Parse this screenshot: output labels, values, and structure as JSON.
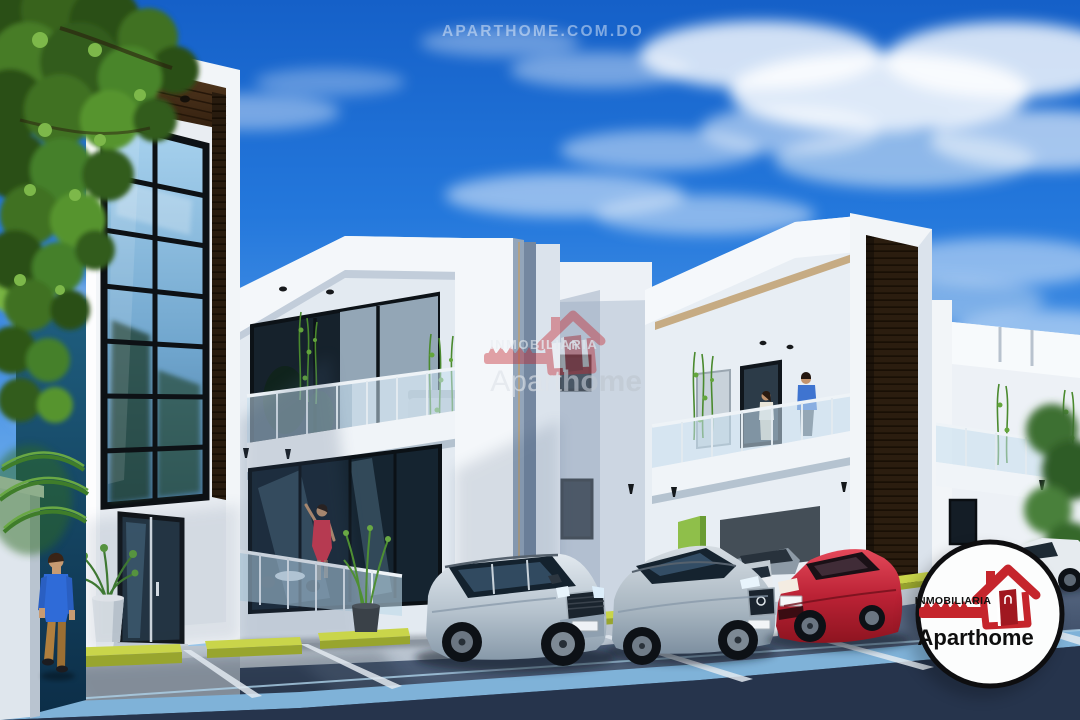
{
  "watermarks": {
    "top": "APARTHOME.COM.DO",
    "center": {
      "small": "INMOBILIARIA",
      "brand_regular": "Apart",
      "brand_bold": "home"
    }
  },
  "badge": {
    "small": "INMOBILIARIA",
    "brand_regular": "Apart",
    "brand_bold": "home"
  },
  "colors": {
    "brand_red": "#c5252c",
    "badge_ink": "#101010",
    "badge_ring": "#0e0e10",
    "sky_top": "#1560c8",
    "sky_horizon": "#b9dcf4",
    "wall_white": "#f2f5f8",
    "wall_shade": "#c2cedd",
    "wood_dark": "#3a2715",
    "glass_dark": "#16242f",
    "glass_sky": "#8fc2e6",
    "asphalt": "#3c4c66",
    "curb_blue": "#7fb2d8",
    "wheelstop_yellow": "#c9d54a",
    "accent_green": "#8fbf4a",
    "tree_green": "#3f7124",
    "teal_wall": "#1f5f80",
    "car_red": "#b01e2e",
    "car_silver": "#c2ccd4"
  }
}
